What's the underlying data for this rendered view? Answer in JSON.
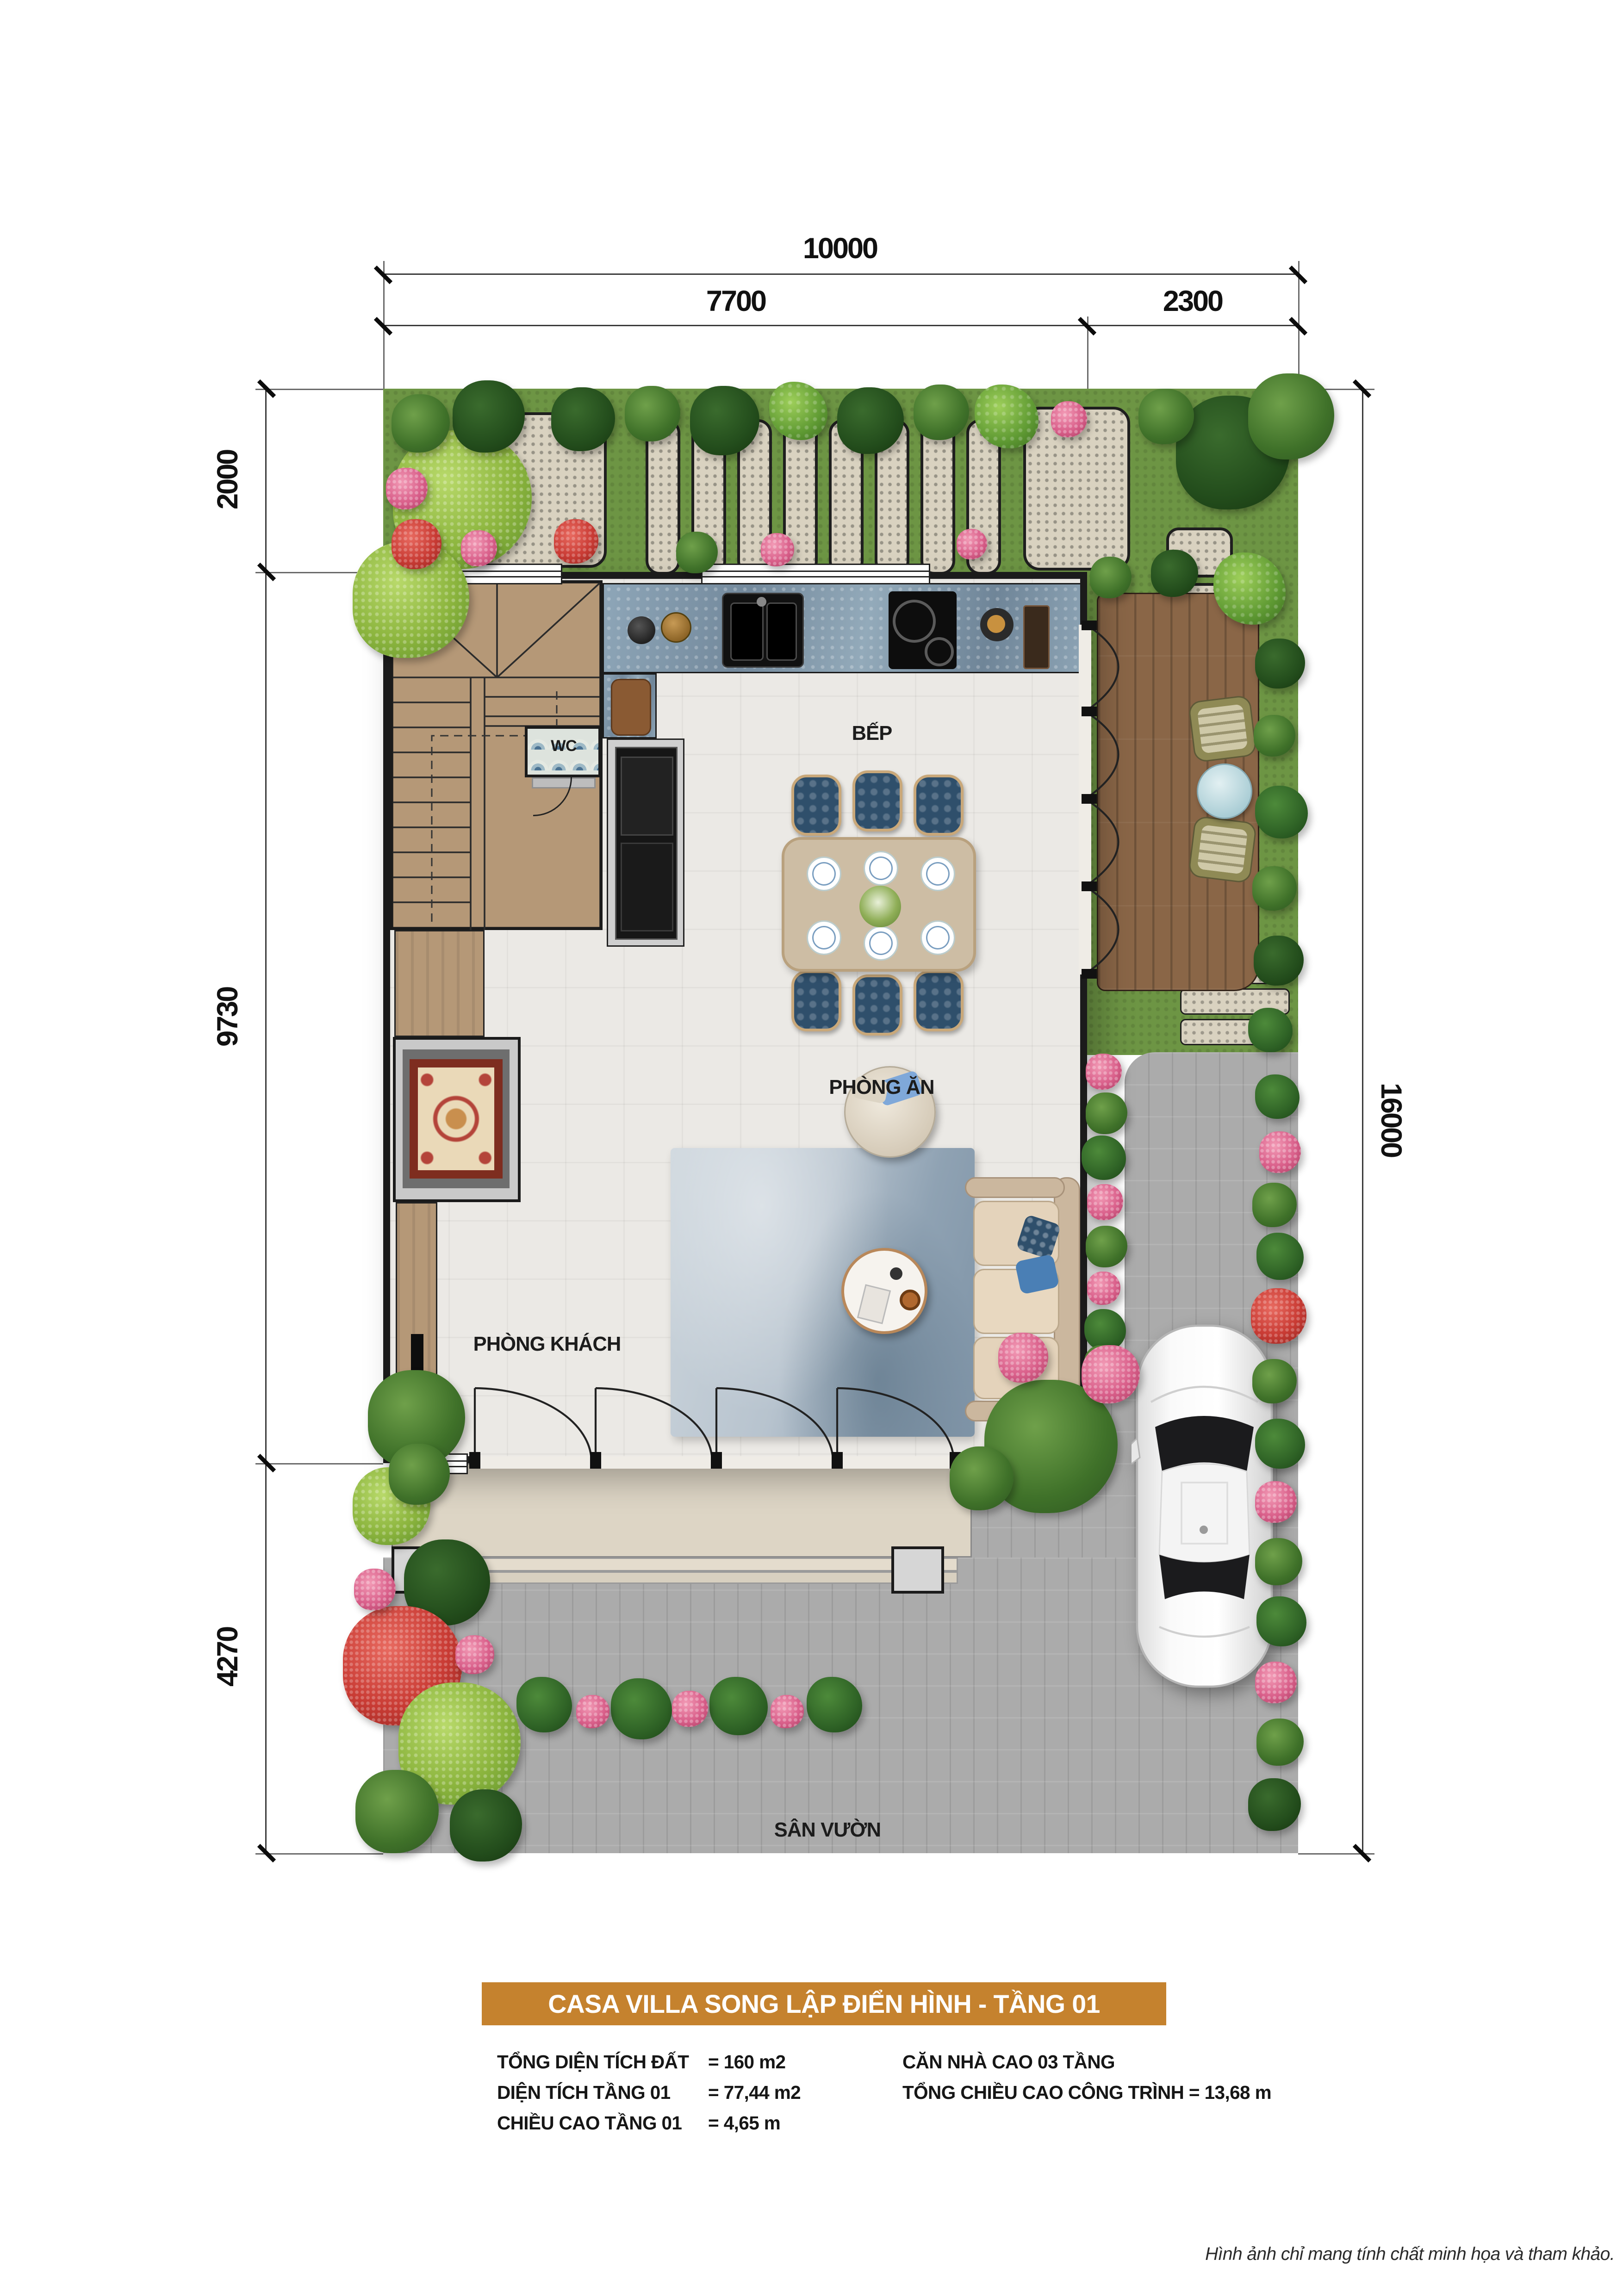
{
  "title": "CASA VILLA SONG LẬP ĐIỂN HÌNH - TẦNG 01",
  "dimensions": {
    "top_total": "10000",
    "top_left": "7700",
    "top_right": "2300",
    "left_top": "2000",
    "left_middle": "9730",
    "left_bottom": "4270",
    "right_total": "16000"
  },
  "rooms": {
    "kitchen": "BẾP",
    "dining": "PHÒNG ĂN",
    "living": "PHÒNG KHÁCH",
    "wc": "WC",
    "yard": "SÂN VƯỜN"
  },
  "specs_left": [
    {
      "label": "TỔNG DIỆN TÍCH ĐẤT",
      "value": "= 160 m2"
    },
    {
      "label": "DIỆN TÍCH TẦNG 01",
      "value": "= 77,44 m2"
    },
    {
      "label": "CHIỀU CAO TẦNG 01",
      "value": "= 4,65 m"
    }
  ],
  "specs_right": [
    "CĂN NHÀ CAO 03 TẦNG",
    "TỔNG CHIỀU CAO CÔNG TRÌNH = 13,68 m"
  ],
  "footer_note": "Hình ảnh chỉ mang tính chất minh họa và tham khảo.",
  "colors": {
    "banner": "#c5822e",
    "banner_text": "#ffffff"
  }
}
